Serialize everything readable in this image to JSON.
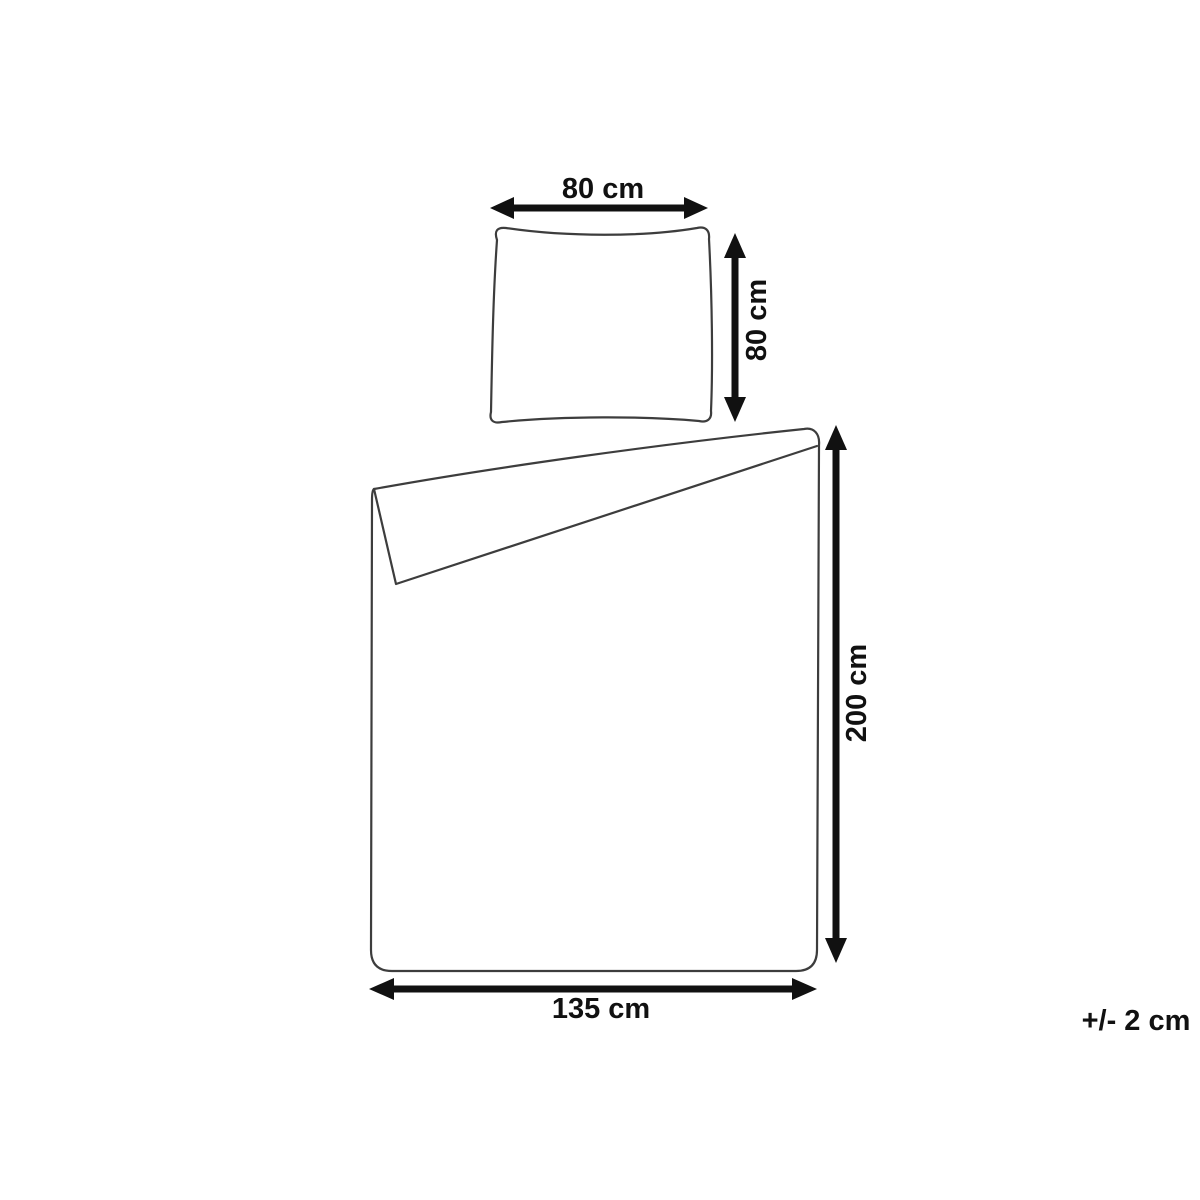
{
  "colors": {
    "background": "#ffffff",
    "outline": "#3d3d3d",
    "arrow": "#111111",
    "text": "#111111"
  },
  "dimensions": {
    "pillow_width": {
      "label": "80 cm"
    },
    "pillow_height": {
      "label": "80 cm"
    },
    "duvet_height": {
      "label": "200 cm"
    },
    "duvet_width": {
      "label": "135 cm"
    }
  },
  "tolerance_note": "+/- 2 cm"
}
